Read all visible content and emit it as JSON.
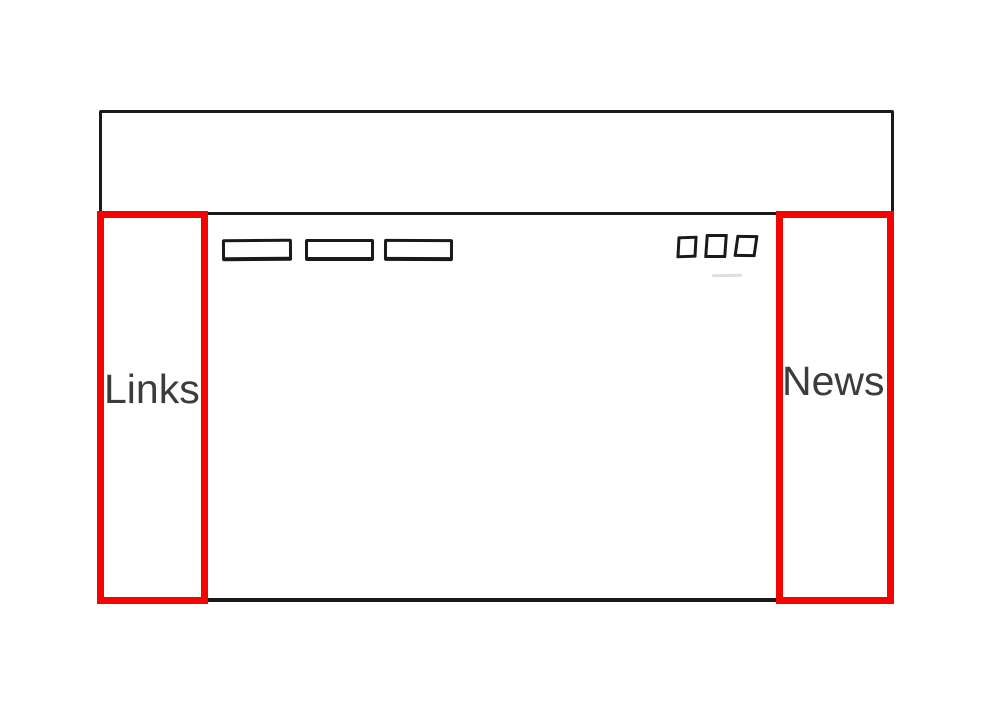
{
  "colors": {
    "background": "#FFFFFF",
    "outline": "#1A1A1A",
    "highlight": "#F40400",
    "label": "#3C3C3C"
  },
  "sketch": {
    "left_panel": {
      "label": "Links"
    },
    "right_panel": {
      "label": "News"
    }
  }
}
